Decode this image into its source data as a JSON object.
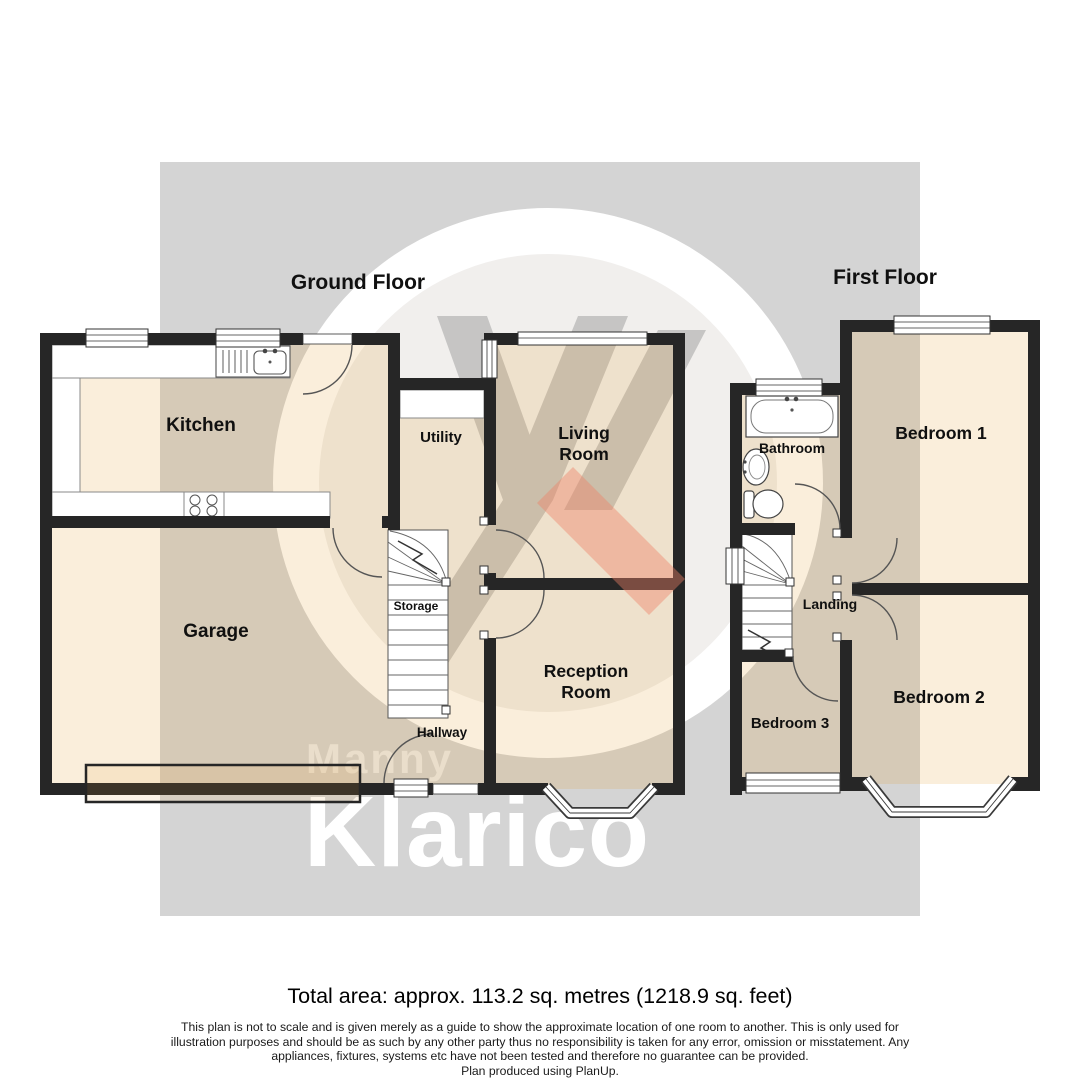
{
  "ground_floor": {
    "title": "Ground Floor",
    "rooms": {
      "kitchen": "Kitchen",
      "garage": "Garage",
      "utility": "Utility",
      "living_line1": "Living",
      "living_line2": "Room",
      "storage": "Storage",
      "hallway": "Hallway",
      "reception_line1": "Reception",
      "reception_line2": "Room"
    }
  },
  "first_floor": {
    "title": "First Floor",
    "rooms": {
      "bathroom": "Bathroom",
      "bedroom1": "Bedroom 1",
      "landing": "Landing",
      "bedroom2": "Bedroom 2",
      "bedroom3": "Bedroom 3"
    }
  },
  "watermark": {
    "name_line1": "Manny",
    "name_line2": "Klarico"
  },
  "footer": {
    "total_area": "Total area: approx. 113.2 sq. metres (1218.9 sq. feet)",
    "disclaimer_line1": "This plan is not to scale and is given merely as a guide to show the approximate location of one room to another. This is only used for",
    "disclaimer_line2": "illustration purposes and should be as such by any other party thus no responsibility is taken for any error, omission or misstatement. Any",
    "disclaimer_line3": "appliances, fixtures, systems etc have not been tested and therefore no guarantee can be provided.",
    "produced_by": "Plan produced using PlanUp."
  },
  "colors": {
    "wall": "#262626",
    "floor_tint": "#e4a036",
    "background_gray": "#d4d4d4",
    "watermark_circle": "#ffffff",
    "watermark_gray": "#c6c5c4",
    "watermark_red": "#ef8166"
  }
}
